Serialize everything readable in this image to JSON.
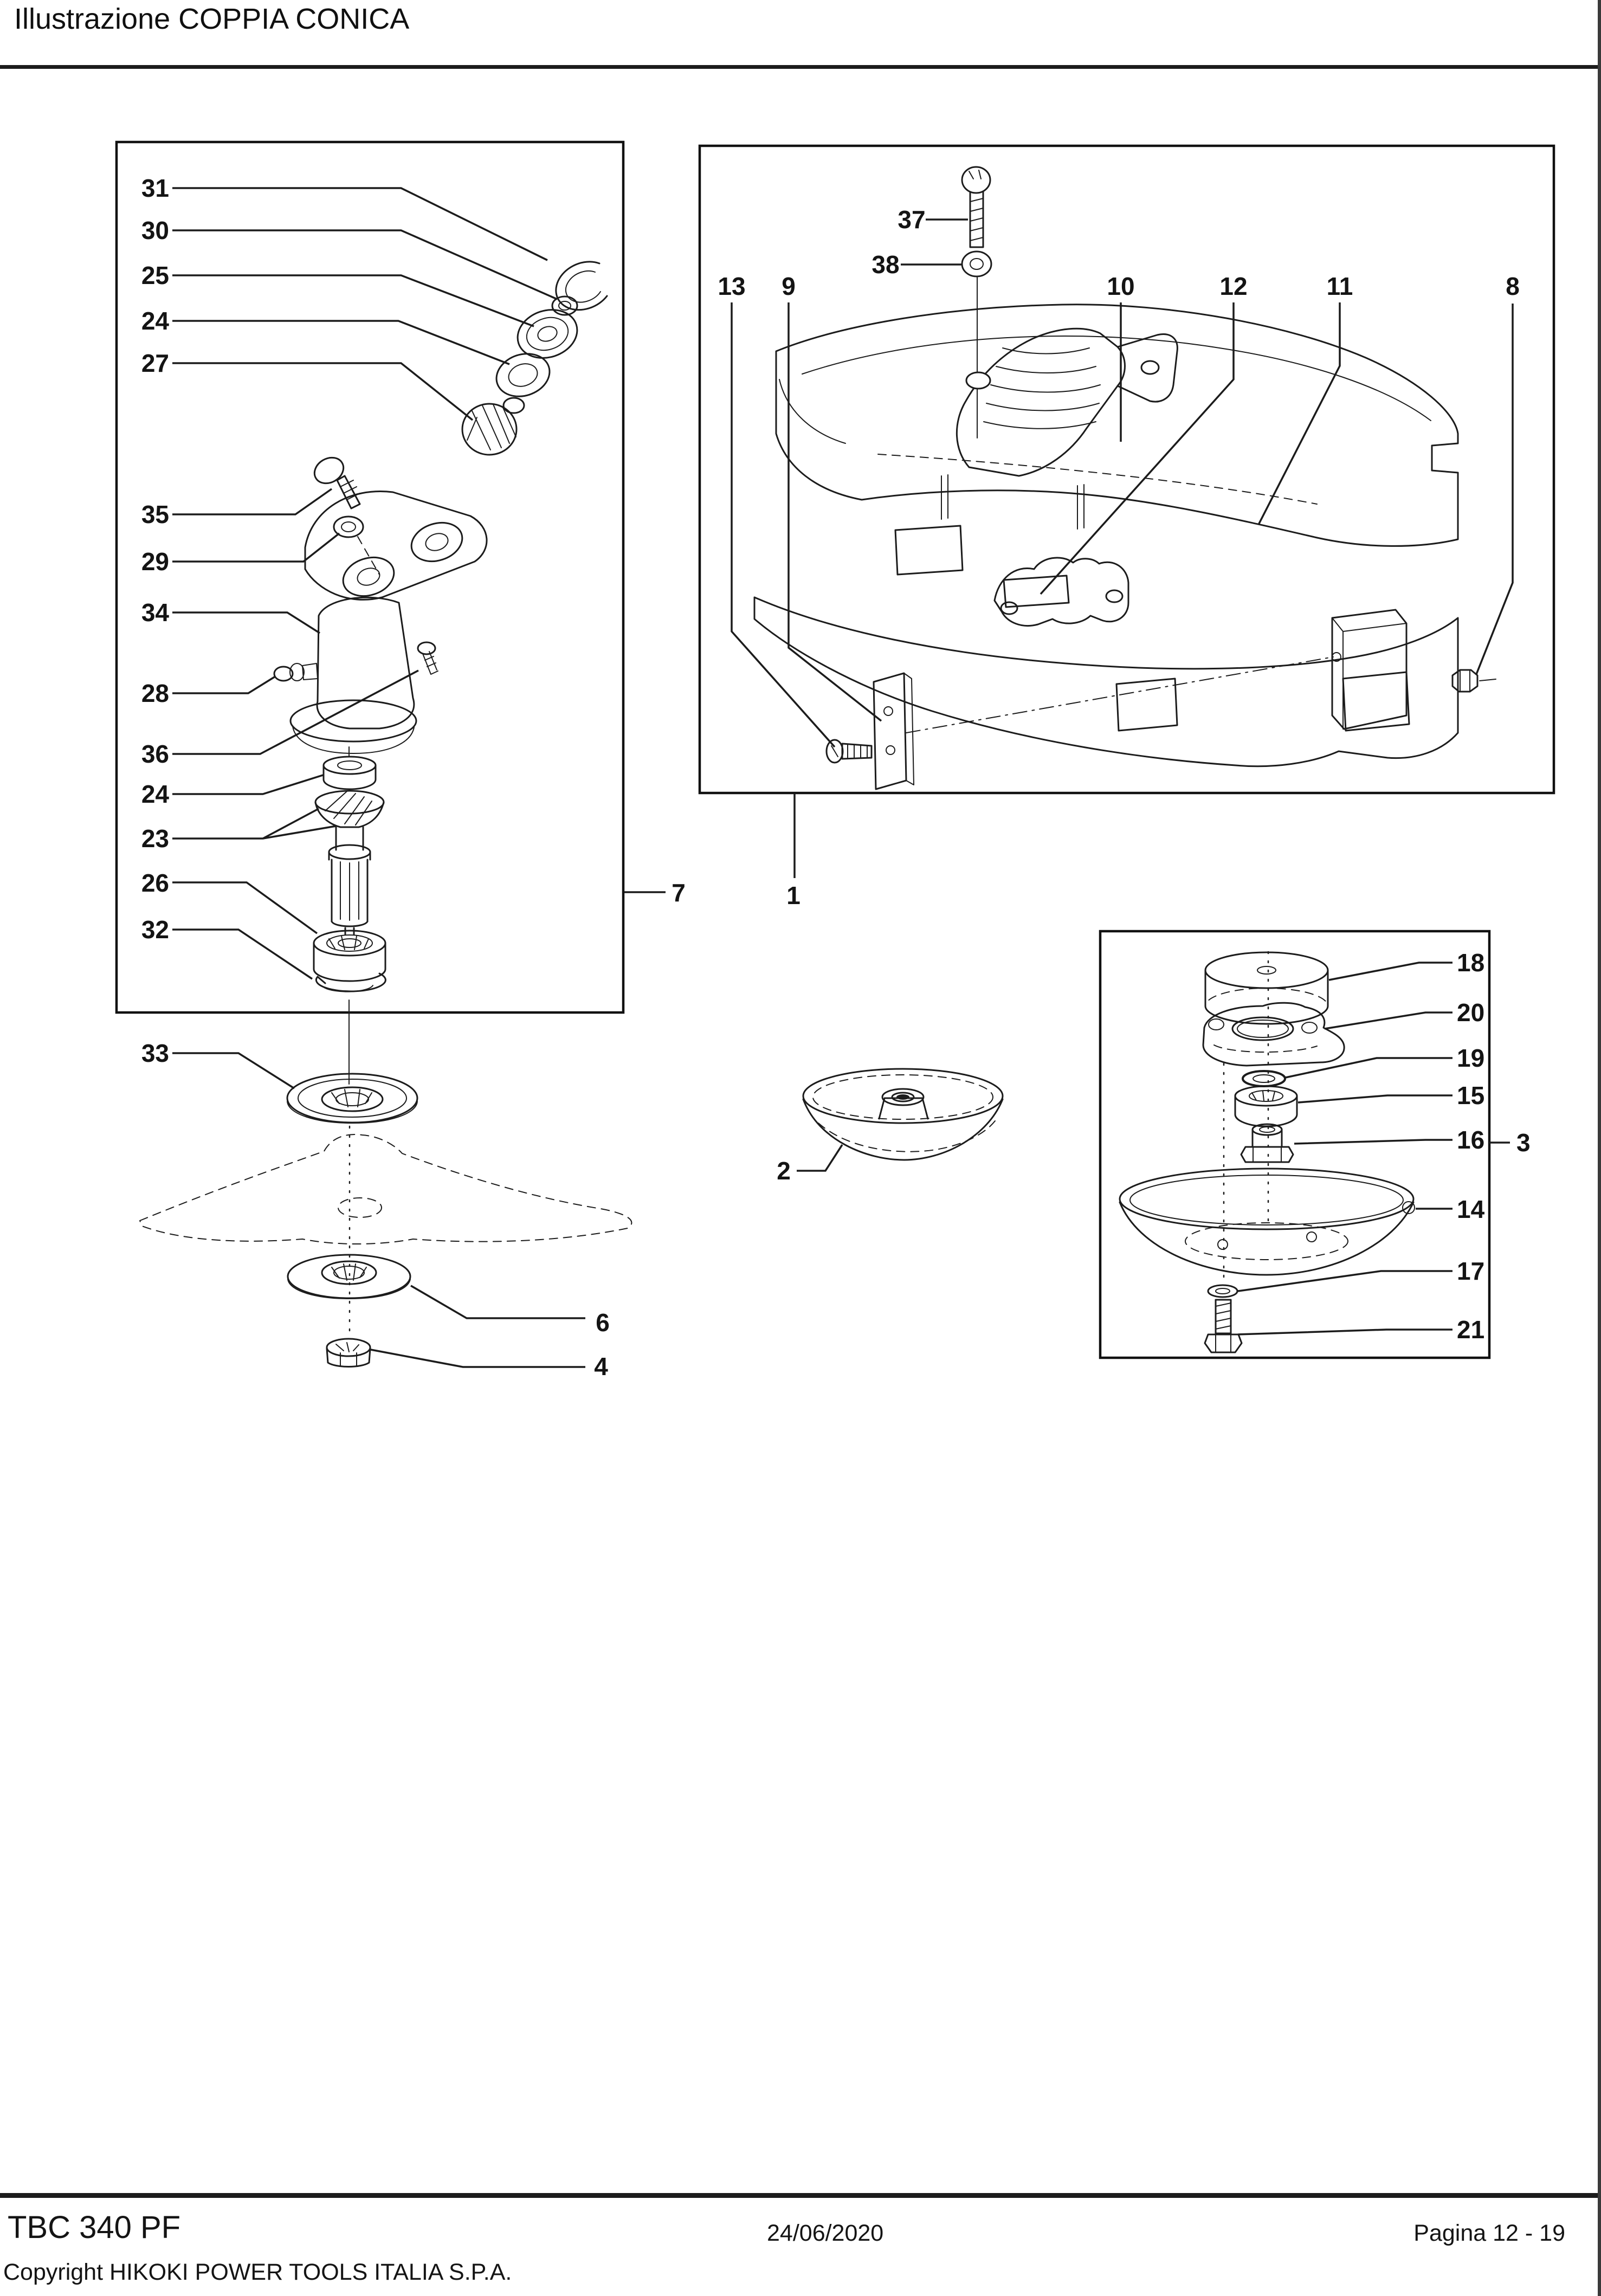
{
  "header": {
    "title": "Illustrazione  COPPIA CONICA"
  },
  "footer": {
    "model": "TBC 340 PF",
    "date": "24/06/2020",
    "page": "Pagina 12 - 19",
    "copyright": "Copyright HIKOKI POWER TOOLS ITALIA S.P.A."
  },
  "diagram": {
    "callouts": {
      "n31": "31",
      "n30": "30",
      "n25": "25",
      "n24a": "24",
      "n27": "27",
      "n35": "35",
      "n29": "29",
      "n34": "34",
      "n28": "28",
      "n36": "36",
      "n24b": "24",
      "n23": "23",
      "n26": "26",
      "n32": "32",
      "n33": "33",
      "n37": "37",
      "n38": "38",
      "n13": "13",
      "n9": "9",
      "n10": "10",
      "n12": "12",
      "n11": "11",
      "n8": "8",
      "n7": "7",
      "n1": "1",
      "n18": "18",
      "n20": "20",
      "n19": "19",
      "n15": "15",
      "n16": "16",
      "n3": "3",
      "n14": "14",
      "n17": "17",
      "n21": "21",
      "n2": "2",
      "n6": "6",
      "n4": "4"
    }
  }
}
